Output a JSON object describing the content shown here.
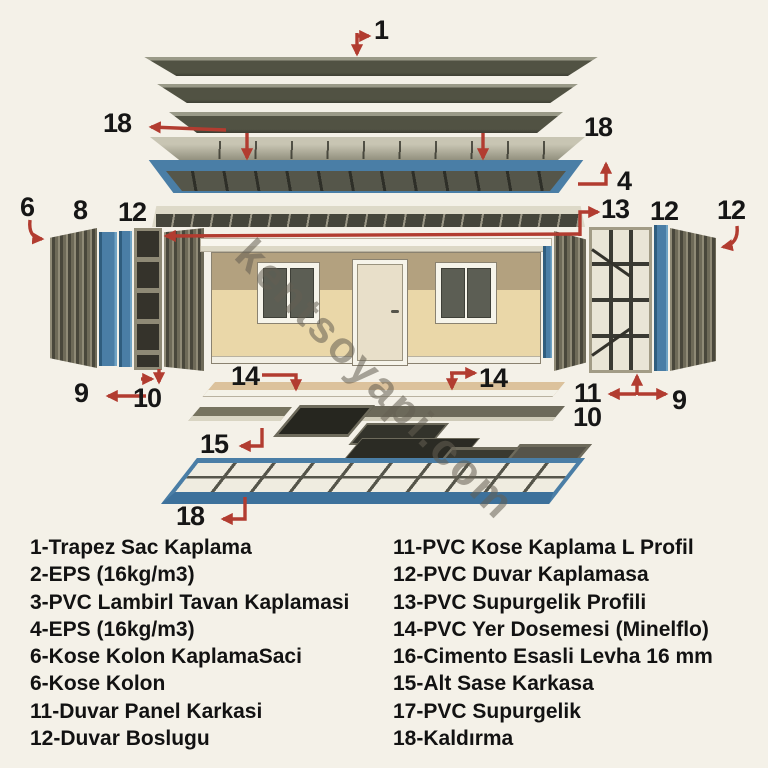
{
  "watermark": "kentsoyapi.com",
  "callouts": [
    "1",
    "18",
    "18",
    "4",
    "6",
    "8",
    "12",
    "13",
    "12",
    "12",
    "9",
    "10",
    "14",
    "14",
    "11",
    "9",
    "10",
    "15",
    "18"
  ],
  "legend": {
    "left": [
      "1-Trapez Sac Kaplama",
      "2-EPS (16kg/m3)",
      "3-PVC Lambirl Tavan Kaplamasi",
      "4-EPS (16kg/m3)",
      "6-Kose Kolon KaplamaSaci",
      "6-Kose Kolon",
      "11-Duvar Panel Karkasi",
      "12-Duvar Boslugu"
    ],
    "right": [
      "11-PVC Kose Kaplama L Profil",
      "12-PVC Duvar Kaplamasa",
      "13-PVC Supurgelik Profili",
      "14-PVC Yer Dosemesi (Minelflo)",
      "16-Cimento Esasli Levha 16 mm",
      "15-Alt Sase Karkasa",
      "17-PVC Supurgelik",
      "18-Kaldırma"
    ]
  },
  "colors": {
    "background": "#f4f1e8",
    "arrow_red": "#b23c30",
    "frame_blue": "#4a7ea6",
    "panel_olive": "#515243",
    "wall_beige": "#ead7a8",
    "wall_band_tan": "#b3a17f",
    "text_black": "#161616"
  }
}
